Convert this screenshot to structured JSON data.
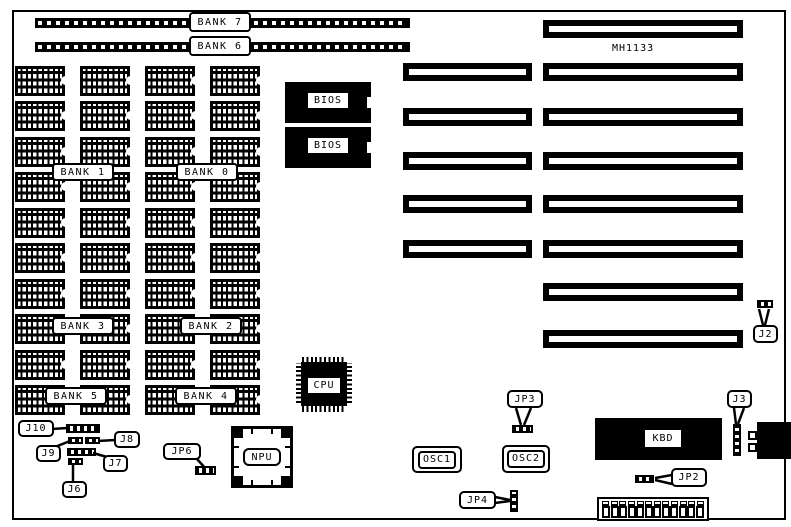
{
  "colors": {
    "ink": "#000000",
    "background": "#ffffff"
  },
  "board": {
    "model_label": "MH1133",
    "simm_banks": [
      {
        "label": "BANK 7"
      },
      {
        "label": "BANK 6"
      }
    ],
    "memory_banks": [
      "BANK 1",
      "BANK 0",
      "BANK 3",
      "BANK 2",
      "BANK 5",
      "BANK 4"
    ],
    "memory_grid": {
      "columns": 4,
      "rows": 10
    },
    "bios_chips": [
      {
        "label": "BIOS"
      },
      {
        "label": "BIOS"
      }
    ],
    "cpu": {
      "label": "CPU"
    },
    "npu": {
      "label": "NPU"
    },
    "keyboard_controller": {
      "label": "KBD"
    },
    "oscillators": [
      {
        "label": "OSC1"
      },
      {
        "label": "OSC2"
      }
    ],
    "expansion_slots": {
      "left_column": 5,
      "right_column": 8
    },
    "power_connector": {
      "pins": 12
    },
    "jumpers": {
      "j2": "J2",
      "j3": "J3",
      "j6": "J6",
      "j7": "J7",
      "j8": "J8",
      "j9": "J9",
      "j10": "J10",
      "jp2": "JP2",
      "jp3": "JP3",
      "jp4": "JP4",
      "jp6": "JP6"
    }
  }
}
